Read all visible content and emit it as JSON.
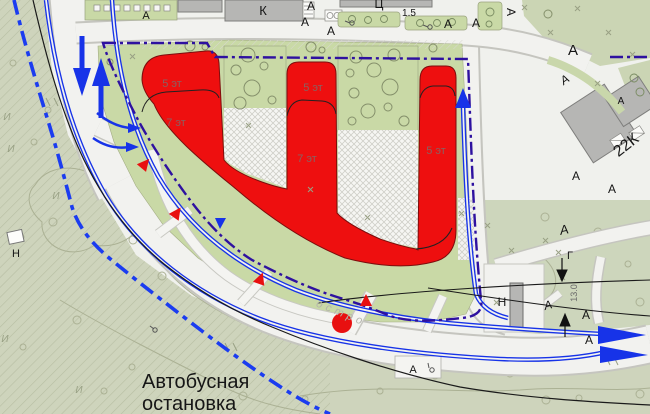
{
  "map_title_note": "site plan fragment with proposed residential building and bus stop",
  "colors": {
    "building_red": "#ee0f0f",
    "building_red_outline": "#7c0d0d",
    "road_marking_blue": "#1733e8",
    "boundary_purple": "#2e11a0",
    "boundary_blue_dash": "#1b3cf0",
    "site_green": "#c9d9a6",
    "park_olive": "#ced4bc",
    "existing_building_gray": "#b6b6b4"
  },
  "labels": [
    {
      "name": "bus-stop-label-line1",
      "text": "Автобусная",
      "x": 142,
      "y": 388,
      "s": 20,
      "a": "start",
      "c": "#161616"
    },
    {
      "name": "bus-stop-label-line2",
      "text": "остановка",
      "x": 142,
      "y": 410,
      "s": 20,
      "a": "start",
      "c": "#161616"
    },
    {
      "name": "floor-label-left-5",
      "text": "5 эт",
      "x": 172,
      "y": 87,
      "s": 11,
      "c": "#8a6161"
    },
    {
      "name": "floor-label-left-7",
      "text": "7 эт",
      "x": 176,
      "y": 126,
      "s": 11,
      "c": "#8a6161"
    },
    {
      "name": "floor-label-mid-5",
      "text": "5 эт",
      "x": 313,
      "y": 91,
      "s": 11,
      "c": "#8a6161"
    },
    {
      "name": "floor-label-mid-7",
      "text": "7 эт",
      "x": 307,
      "y": 162,
      "s": 11,
      "c": "#8a6161"
    },
    {
      "name": "floor-label-right-5",
      "text": "5 эт",
      "x": 436,
      "y": 154,
      "s": 11,
      "c": "#8a6161"
    },
    {
      "name": "building-label-k",
      "text": "К",
      "x": 263,
      "y": 15,
      "s": 13,
      "c": "#161616"
    },
    {
      "name": "building-label-c",
      "text": "Ц",
      "x": 379,
      "y": 8,
      "s": 12,
      "c": "#161616"
    },
    {
      "name": "building-label-22k",
      "text": "22К",
      "x": 629,
      "y": 149,
      "s": 16,
      "rot": -38,
      "c": "#161616"
    },
    {
      "name": "building-label-n-west",
      "text": "Н",
      "x": 16,
      "y": 257,
      "s": 11,
      "c": "#161616"
    },
    {
      "name": "building-label-n-east",
      "text": "Н",
      "x": 502,
      "y": 306,
      "s": 12,
      "c": "#161616"
    },
    {
      "name": "utility-label-g",
      "text": "Г",
      "x": 570,
      "y": 259,
      "s": 11,
      "c": "#161616"
    },
    {
      "name": "dimension-label-15",
      "text": "1.5",
      "x": 409,
      "y": 16,
      "s": 10,
      "c": "#161616"
    },
    {
      "name": "dimension-label-130",
      "text": "13.0",
      "x": 577,
      "y": 293,
      "s": 9,
      "rot": -90,
      "c": "#6a6a6a"
    },
    {
      "name": "surface-label-a-1",
      "text": "А",
      "x": 146,
      "y": 19,
      "s": 11
    },
    {
      "name": "surface-label-a-2",
      "text": "А",
      "x": 311,
      "y": 10,
      "s": 12
    },
    {
      "name": "surface-label-a-3",
      "text": "А",
      "x": 305,
      "y": 26,
      "s": 12
    },
    {
      "name": "surface-label-a-4",
      "text": "А",
      "x": 331,
      "y": 35,
      "s": 12
    },
    {
      "name": "surface-label-a-5",
      "text": "А",
      "x": 448,
      "y": 28,
      "s": 12
    },
    {
      "name": "surface-label-a-6",
      "text": "А",
      "x": 476,
      "y": 27,
      "s": 12
    },
    {
      "name": "surface-label-a-7",
      "text": "А",
      "x": 507,
      "y": 12,
      "s": 12,
      "rot": 90
    },
    {
      "name": "surface-label-a-8",
      "text": "А",
      "x": 573,
      "y": 55,
      "s": 15
    },
    {
      "name": "surface-label-a-9",
      "text": "А",
      "x": 567,
      "y": 83,
      "s": 12,
      "rot": -35,
      "it": 1
    },
    {
      "name": "surface-label-a-10",
      "text": "А",
      "x": 621,
      "y": 104,
      "s": 10
    },
    {
      "name": "surface-label-a-11",
      "text": "А",
      "x": 576,
      "y": 180,
      "s": 12
    },
    {
      "name": "surface-label-a-12",
      "text": "А",
      "x": 612,
      "y": 193,
      "s": 12
    },
    {
      "name": "surface-label-a-13",
      "text": "А",
      "x": 565,
      "y": 234,
      "s": 13,
      "rot": -12,
      "it": 1
    },
    {
      "name": "surface-label-a-14",
      "text": "А",
      "x": 549,
      "y": 309,
      "s": 12,
      "rot": -15,
      "it": 1
    },
    {
      "name": "surface-label-a-15",
      "text": "А",
      "x": 586,
      "y": 319,
      "s": 12
    },
    {
      "name": "surface-label-a-16",
      "text": "А",
      "x": 589,
      "y": 344,
      "s": 12
    },
    {
      "name": "surface-label-a-17",
      "text": "А",
      "x": 413,
      "y": 373,
      "s": 11
    },
    {
      "name": "ground-label-i-1",
      "text": "И",
      "x": 7,
      "y": 120,
      "s": 10,
      "it": 1,
      "c": "#98a084"
    },
    {
      "name": "ground-label-i-2",
      "text": "И",
      "x": 11,
      "y": 152,
      "s": 10,
      "it": 1,
      "c": "#98a084"
    },
    {
      "name": "ground-label-i-3",
      "text": "И",
      "x": 56,
      "y": 199,
      "s": 10,
      "it": 1,
      "c": "#98a084"
    },
    {
      "name": "ground-label-i-4",
      "text": "И",
      "x": 5,
      "y": 342,
      "s": 10,
      "it": 1,
      "c": "#98a084"
    },
    {
      "name": "ground-label-i-5",
      "text": "И",
      "x": 79,
      "y": 393,
      "s": 10,
      "it": 1,
      "c": "#98a084"
    },
    {
      "name": "street-name-fragment",
      "text": "остро",
      "x": 340,
      "y": 316,
      "s": 11,
      "rot": 22,
      "it": 1,
      "c": "#b3b3ab",
      "ls": 4
    }
  ]
}
